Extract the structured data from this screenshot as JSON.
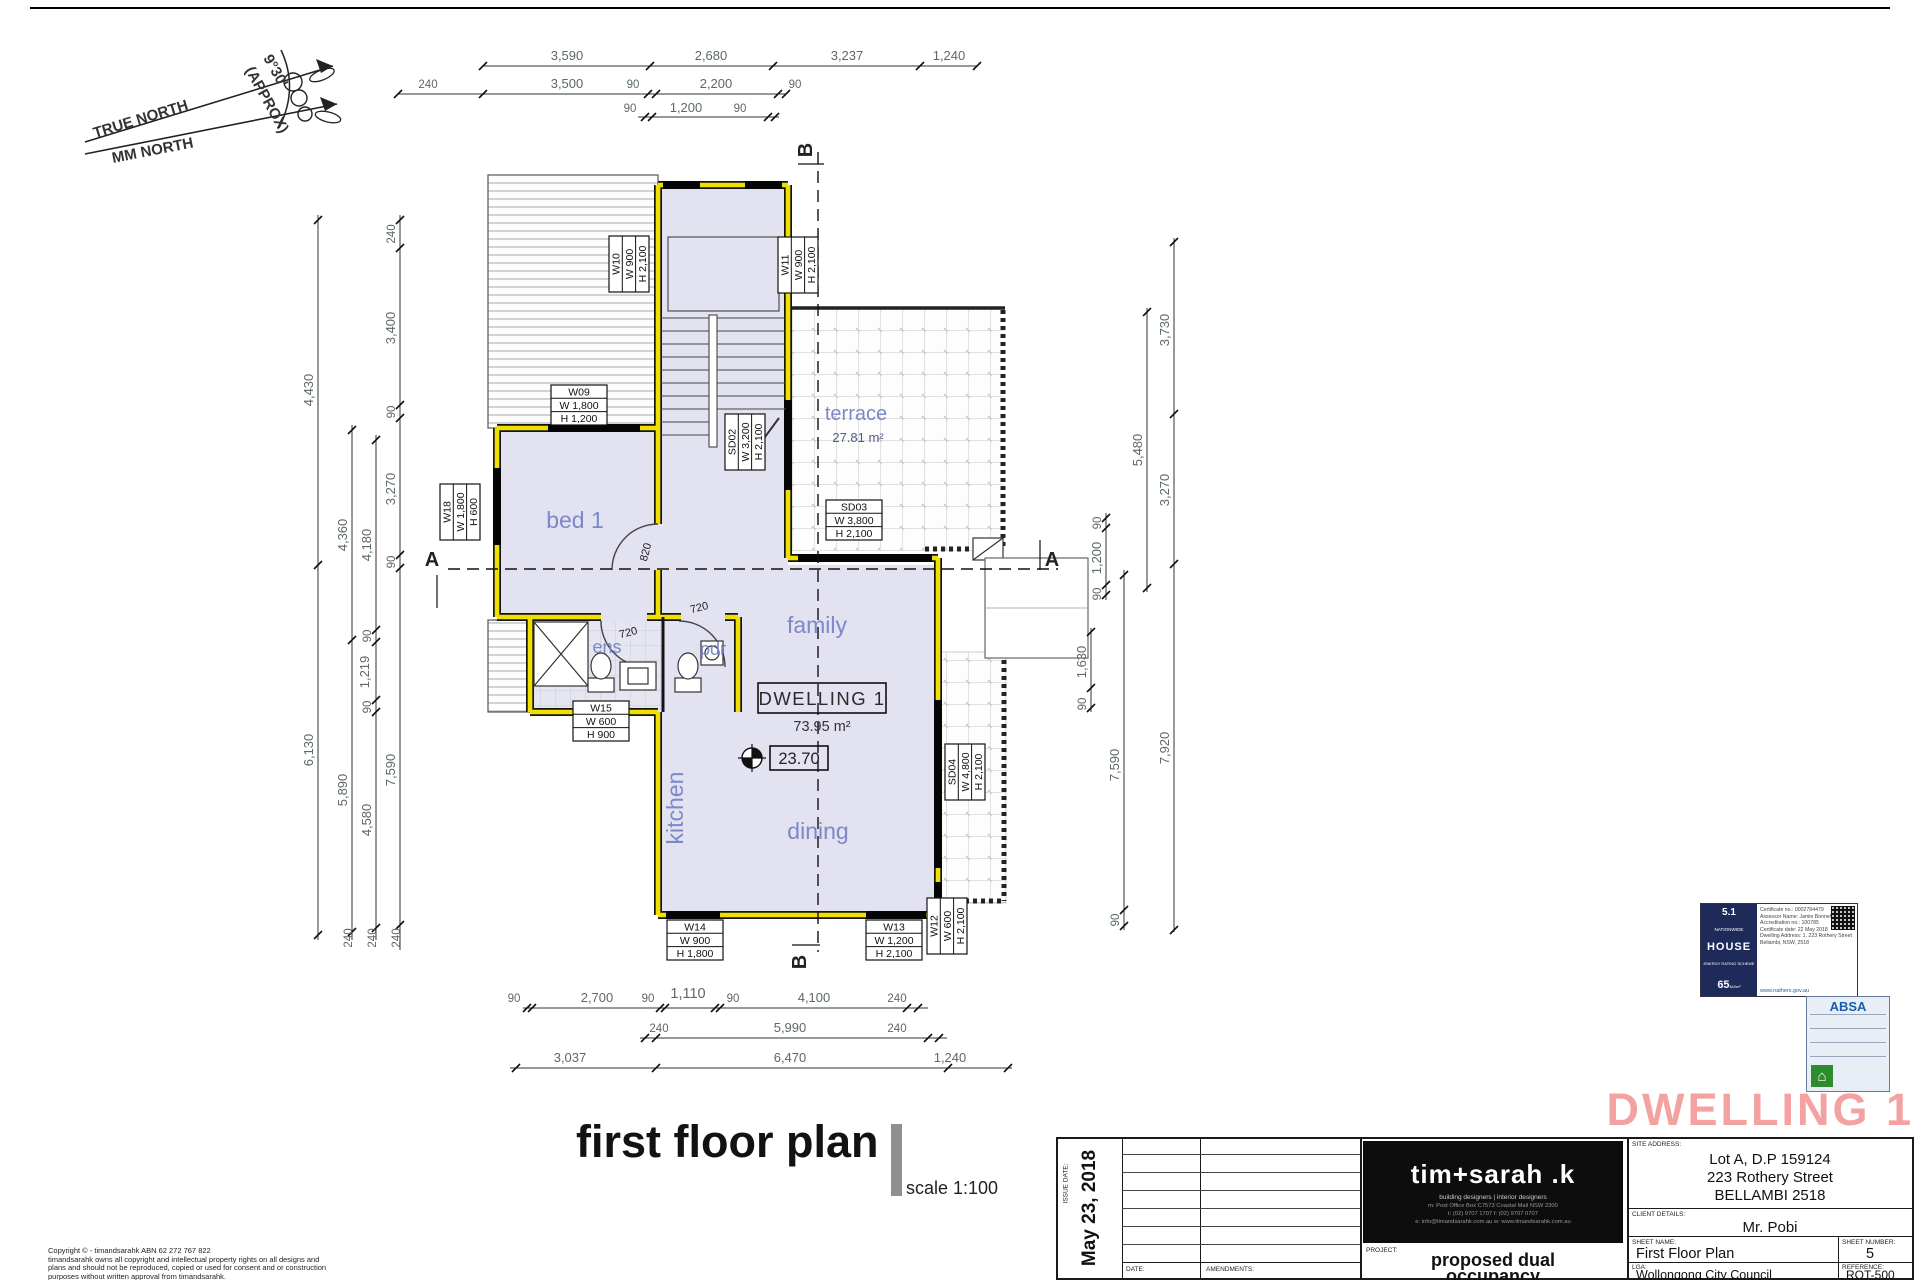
{
  "north": {
    "true_label": "TRUE NORTH",
    "mag_label": "MM NORTH",
    "angle": "9°30'",
    "angle_note": "(APPROX)"
  },
  "dim": {
    "top1": [
      "3,590",
      "2,680",
      "3,237",
      "1,240"
    ],
    "top2": [
      "240",
      "3,500",
      "90",
      "2,200",
      "90"
    ],
    "top3": [
      "90",
      "1,200",
      "90"
    ],
    "bot1": [
      "90",
      "2,700",
      "90",
      "1,110",
      "90",
      "4,100",
      "240"
    ],
    "bot2": [
      "240",
      "5,990",
      "240"
    ],
    "bot3": [
      "3,037",
      "6,470",
      "1,240"
    ],
    "l1": [
      "4,430",
      "6,130"
    ],
    "l2": [
      "4,360",
      "5,890"
    ],
    "l3": [
      "4,180",
      "90",
      "1,219",
      "90",
      "4,580"
    ],
    "l4": [
      "240",
      "3,400",
      "90",
      "3,270",
      "90",
      "7,590"
    ],
    "lb": [
      "240",
      "240",
      "240"
    ],
    "r1": [
      "90",
      "1,200",
      "90"
    ],
    "r2": [
      "1,630",
      "90"
    ],
    "r3": [
      "7,590",
      "90"
    ],
    "r4": [
      "5,480"
    ],
    "r5": [
      "3,730",
      "3,270",
      "7,920"
    ]
  },
  "windows": [
    {
      "id": "W09",
      "w": "W 1,800",
      "h": "H 1,200"
    },
    {
      "id": "W10",
      "w": "W 900",
      "h": "H 2,100"
    },
    {
      "id": "W11",
      "w": "W 900",
      "h": "H 2,100"
    },
    {
      "id": "W18",
      "w": "W 1,800",
      "h": "H 600"
    },
    {
      "id": "SD02",
      "w": "W 3,200",
      "h": "H 2,100"
    },
    {
      "id": "SD03",
      "w": "W 3,800",
      "h": "H 2,100"
    },
    {
      "id": "SD04",
      "w": "W 4,800",
      "h": "H 2,100"
    },
    {
      "id": "W15",
      "w": "W 600",
      "h": "H 900"
    },
    {
      "id": "W14",
      "w": "W 900",
      "h": "H 1,800"
    },
    {
      "id": "W13",
      "w": "W 1,200",
      "h": "H 2,100"
    },
    {
      "id": "W12",
      "w": "W 600",
      "h": "H 2,100"
    }
  ],
  "doors": {
    "bed": "820",
    "ens": "720",
    "pdr": "720"
  },
  "rooms": {
    "bed": "bed 1",
    "ens": "ens",
    "pdr": "pdr",
    "family": "family",
    "kitchen": "kitchen",
    "dining": "dining",
    "terrace": "terrace",
    "terrace_area": "27.81 m²"
  },
  "dwelling": {
    "label": "DWELLING 1",
    "area": "73.95 m²",
    "level": "23.70"
  },
  "sections": {
    "a": "A",
    "b": "B"
  },
  "plan_title": {
    "text": "first floor plan",
    "scale": "scale 1:100"
  },
  "watermark": "DWELLING 1",
  "titleblock": {
    "issue_date_label": "ISSUE DATE:",
    "issue_date": "May 23, 2018",
    "date_label": "DATE:",
    "amendments_label": "AMENDMENTS:",
    "logo_name": "tim+sarah .k",
    "logo_tagline": "building designers  |  interior designers",
    "logo_line1": "m: Post Office Box C7573 Coastal Mail NSW 2300",
    "logo_line2": "t: (02) 9707 1707    f: (02) 9707 0707",
    "logo_line3": "e: info@timandsarahk.com.au    w: www.timandsarahk.com.au",
    "project_label": "PROJECT:",
    "project_line1": "proposed dual",
    "project_line2": "occupancy",
    "site_label": "SITE ADDRESS:",
    "site1": "Lot A, D.P 159124",
    "site2": "223 Rothery Street",
    "site3": "BELLAMBI 2518",
    "client_label": "CLIENT DETAILS:",
    "client": "Mr. Pobi",
    "sheet_label": "SHEET NAME:",
    "sheet_name": "First Floor Plan",
    "number_label": "SHEET NUMBER:",
    "sheet_number": "5",
    "lga_label": "LGA:",
    "lga": "Wollongong City Council",
    "ref_label": "REFERENCE:",
    "reference": "ROT-500"
  },
  "certs": {
    "nathers": {
      "rating": "5.1",
      "brand1": "NATIONWIDE",
      "brand2": "HOUSE",
      "brand3": "ENERGY RATING SCHEME",
      "score": "65",
      "score_unit": "MJ/m²",
      "line1": "Certificate no.: 0002784479",
      "line2": "Assessor Name: Jamie Bonnefin",
      "line3": "Accreditation no.: 100785",
      "line4": "Certificate date: 22 May 2018",
      "line5": "Dwelling Address: 1, 223 Rothery Street",
      "line6": "Bellambi, NSW, 2518",
      "url": "www.nathers.gov.au"
    },
    "absa": {
      "name": "ABSA"
    }
  },
  "copyright": {
    "line1": "Copyright © - timandsarahk   ABN 62 272 767 822",
    "line2": "timandsarahk owns all copyright and intellectual property rights on all designs and",
    "line3": "plans and should not be reproduced, copied or used for consent and or construction",
    "line4": "purposes without written approval from timandsarahk."
  }
}
